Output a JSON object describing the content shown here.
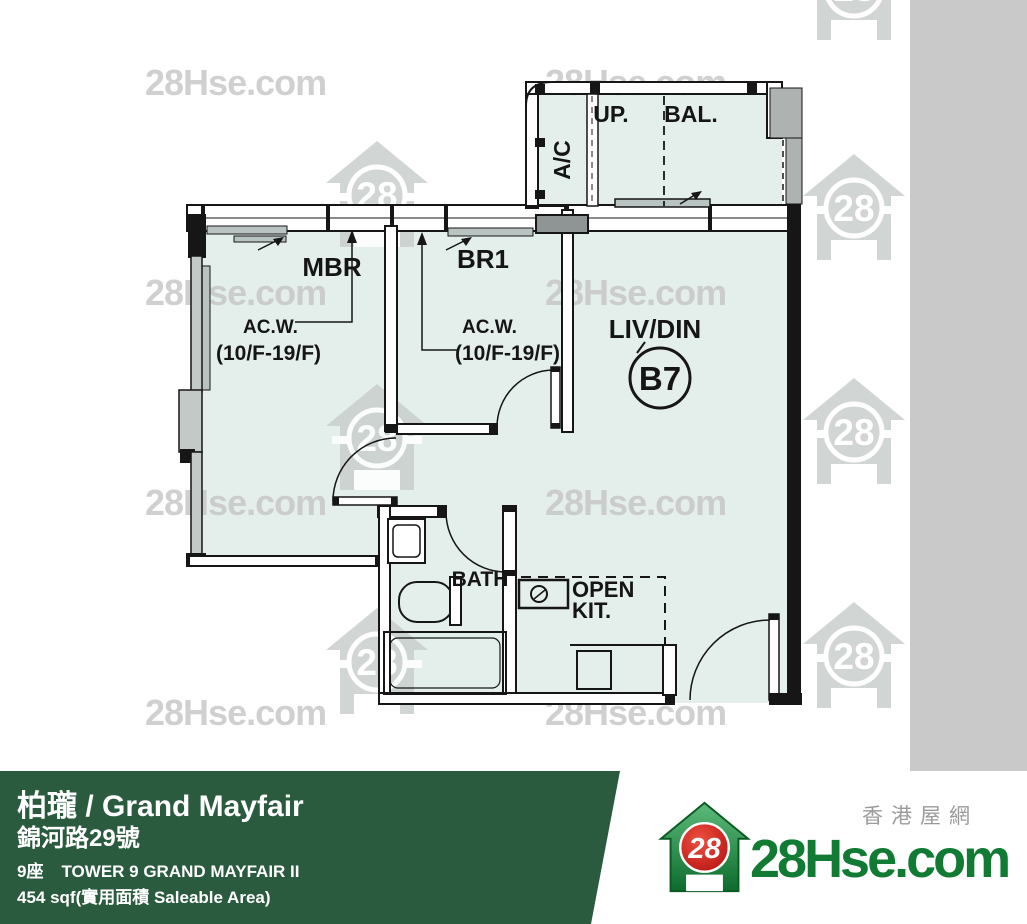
{
  "plan": {
    "rooms": {
      "mbr": "MBR",
      "br1": "BR1",
      "livdin": "LIV/DIN",
      "unit": "B7",
      "bath": "BATH",
      "open_kit_line1": "OPEN",
      "open_kit_line2": "KIT.",
      "ac": "A/C",
      "up": "UP.",
      "bal": "BAL."
    },
    "annotations": {
      "acw": "AC.W.",
      "floors": "(10/F-19/F)"
    }
  },
  "watermark": {
    "text": "28Hse.com",
    "badge": "28"
  },
  "footer": {
    "title": "柏瓏 / Grand Mayfair",
    "address": "錦河路29號",
    "tower_zh": "9座",
    "tower_en": "TOWER 9 GRAND MAYFAIR II",
    "area": "454 sqf(實用面積 Saleable Area)"
  },
  "logo": {
    "site": "28Hse.com",
    "badge": "28",
    "tagline": "香港屋網"
  },
  "colors": {
    "accent_green": "#2b5b3f",
    "logo_green": "#117a33",
    "badge_red": "#cc1313",
    "room_fill": "#e4efec",
    "band_gray": "#c9c9c9",
    "watermark_gray": "#c5c5c5"
  }
}
